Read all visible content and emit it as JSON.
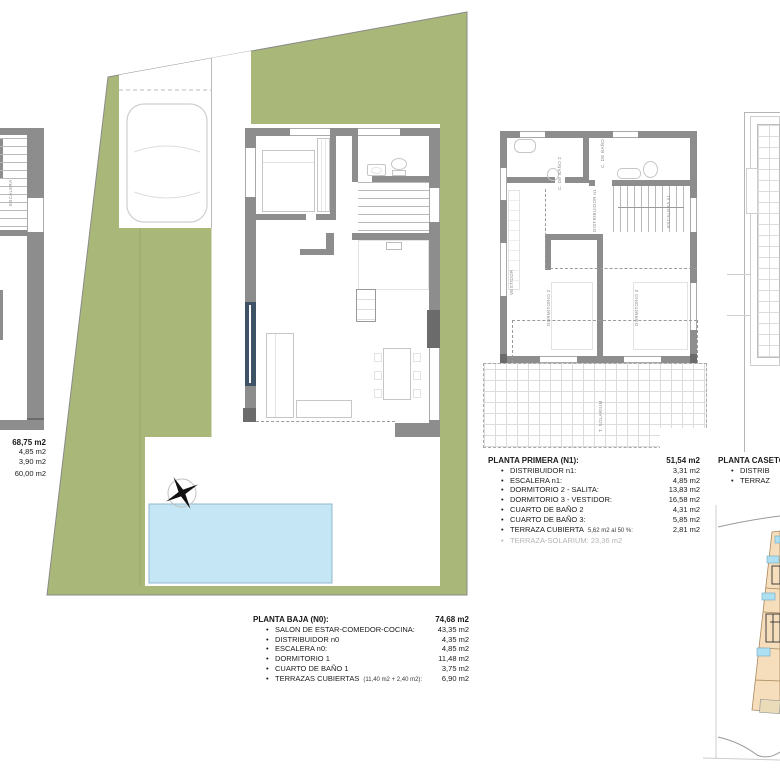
{
  "colors": {
    "plot_green": "#a9b878",
    "pool_blue": "#c5e6f5",
    "wall_grey": "#8d8d8d",
    "window_blue": "#3e5365",
    "parcel_tan": "#f6ddbb",
    "muted_text": "#b5b5b5"
  },
  "left_summary": {
    "total": "68,75 m2",
    "values": [
      "4,85 m2",
      "3,90 m2",
      "60,00 m2"
    ]
  },
  "planta_baja": {
    "title": "PLANTA BAJA (N0):",
    "total": "74,68 m2",
    "items": [
      {
        "label": "SALON DE ESTAR-COMEDOR-COCINA:",
        "note": "",
        "value": "43,35 m2"
      },
      {
        "label": "DISTRIBUIDOR n0",
        "note": "",
        "value": "4,35 m2"
      },
      {
        "label": "ESCALERA n0:",
        "note": "",
        "value": "4,85 m2"
      },
      {
        "label": "DORMITORIO 1",
        "note": "",
        "value": "11,48 m2"
      },
      {
        "label": "CUARTO DE BAÑO 1",
        "note": "",
        "value": "3,75 m2"
      },
      {
        "label": "TERRAZAS CUBIERTAS",
        "note": "(11,40 m2 + 2,40 m2):",
        "value": "6,90 m2"
      }
    ]
  },
  "planta_primera": {
    "title": "PLANTA PRIMERA (N1):",
    "total": "51,54 m2",
    "items": [
      {
        "label": "DISTRIBUIDOR n1:",
        "note": "",
        "value": "3,31 m2"
      },
      {
        "label": "ESCALERA n1:",
        "note": "",
        "value": "4,85 m2"
      },
      {
        "label": "DORMITORIO 2 - SALITA:",
        "note": "",
        "value": "13,83 m2"
      },
      {
        "label": "DORMITORIO 3 - VESTIDOR:",
        "note": "",
        "value": "16,58 m2"
      },
      {
        "label": "CUARTO DE BAÑO 2",
        "note": "",
        "value": "4,31 m2"
      },
      {
        "label": "CUARTO DE BAÑO 3:",
        "note": "",
        "value": "5,85 m2"
      },
      {
        "label": "TERRAZA CUBIERTA",
        "note": "5,62 m2 al 50 %:",
        "value": "2,81 m2"
      },
      {
        "label": "TERRAZA-SOLARIUM: 23,36 m2",
        "note": "",
        "value": ""
      }
    ]
  },
  "planta_caseton": {
    "title": "PLANTA CASETON",
    "items": [
      "DISTRIB",
      "TERRAZ"
    ]
  },
  "rooms": {
    "escalera_left": "ESCALERA",
    "vestidor": "VESTIDOR",
    "bano2": "C. DE BAÑO 2",
    "bano3": "C. DE BAÑO 3",
    "distribuidor_n1": "DISTRIBUIDOR n1",
    "escalera_n1": "ESCALERA n1",
    "dormitorio2": "DORMITORIO 2",
    "dormitorio3": "DORMITORIO 3",
    "solarium": "T. SOLARIUM"
  }
}
